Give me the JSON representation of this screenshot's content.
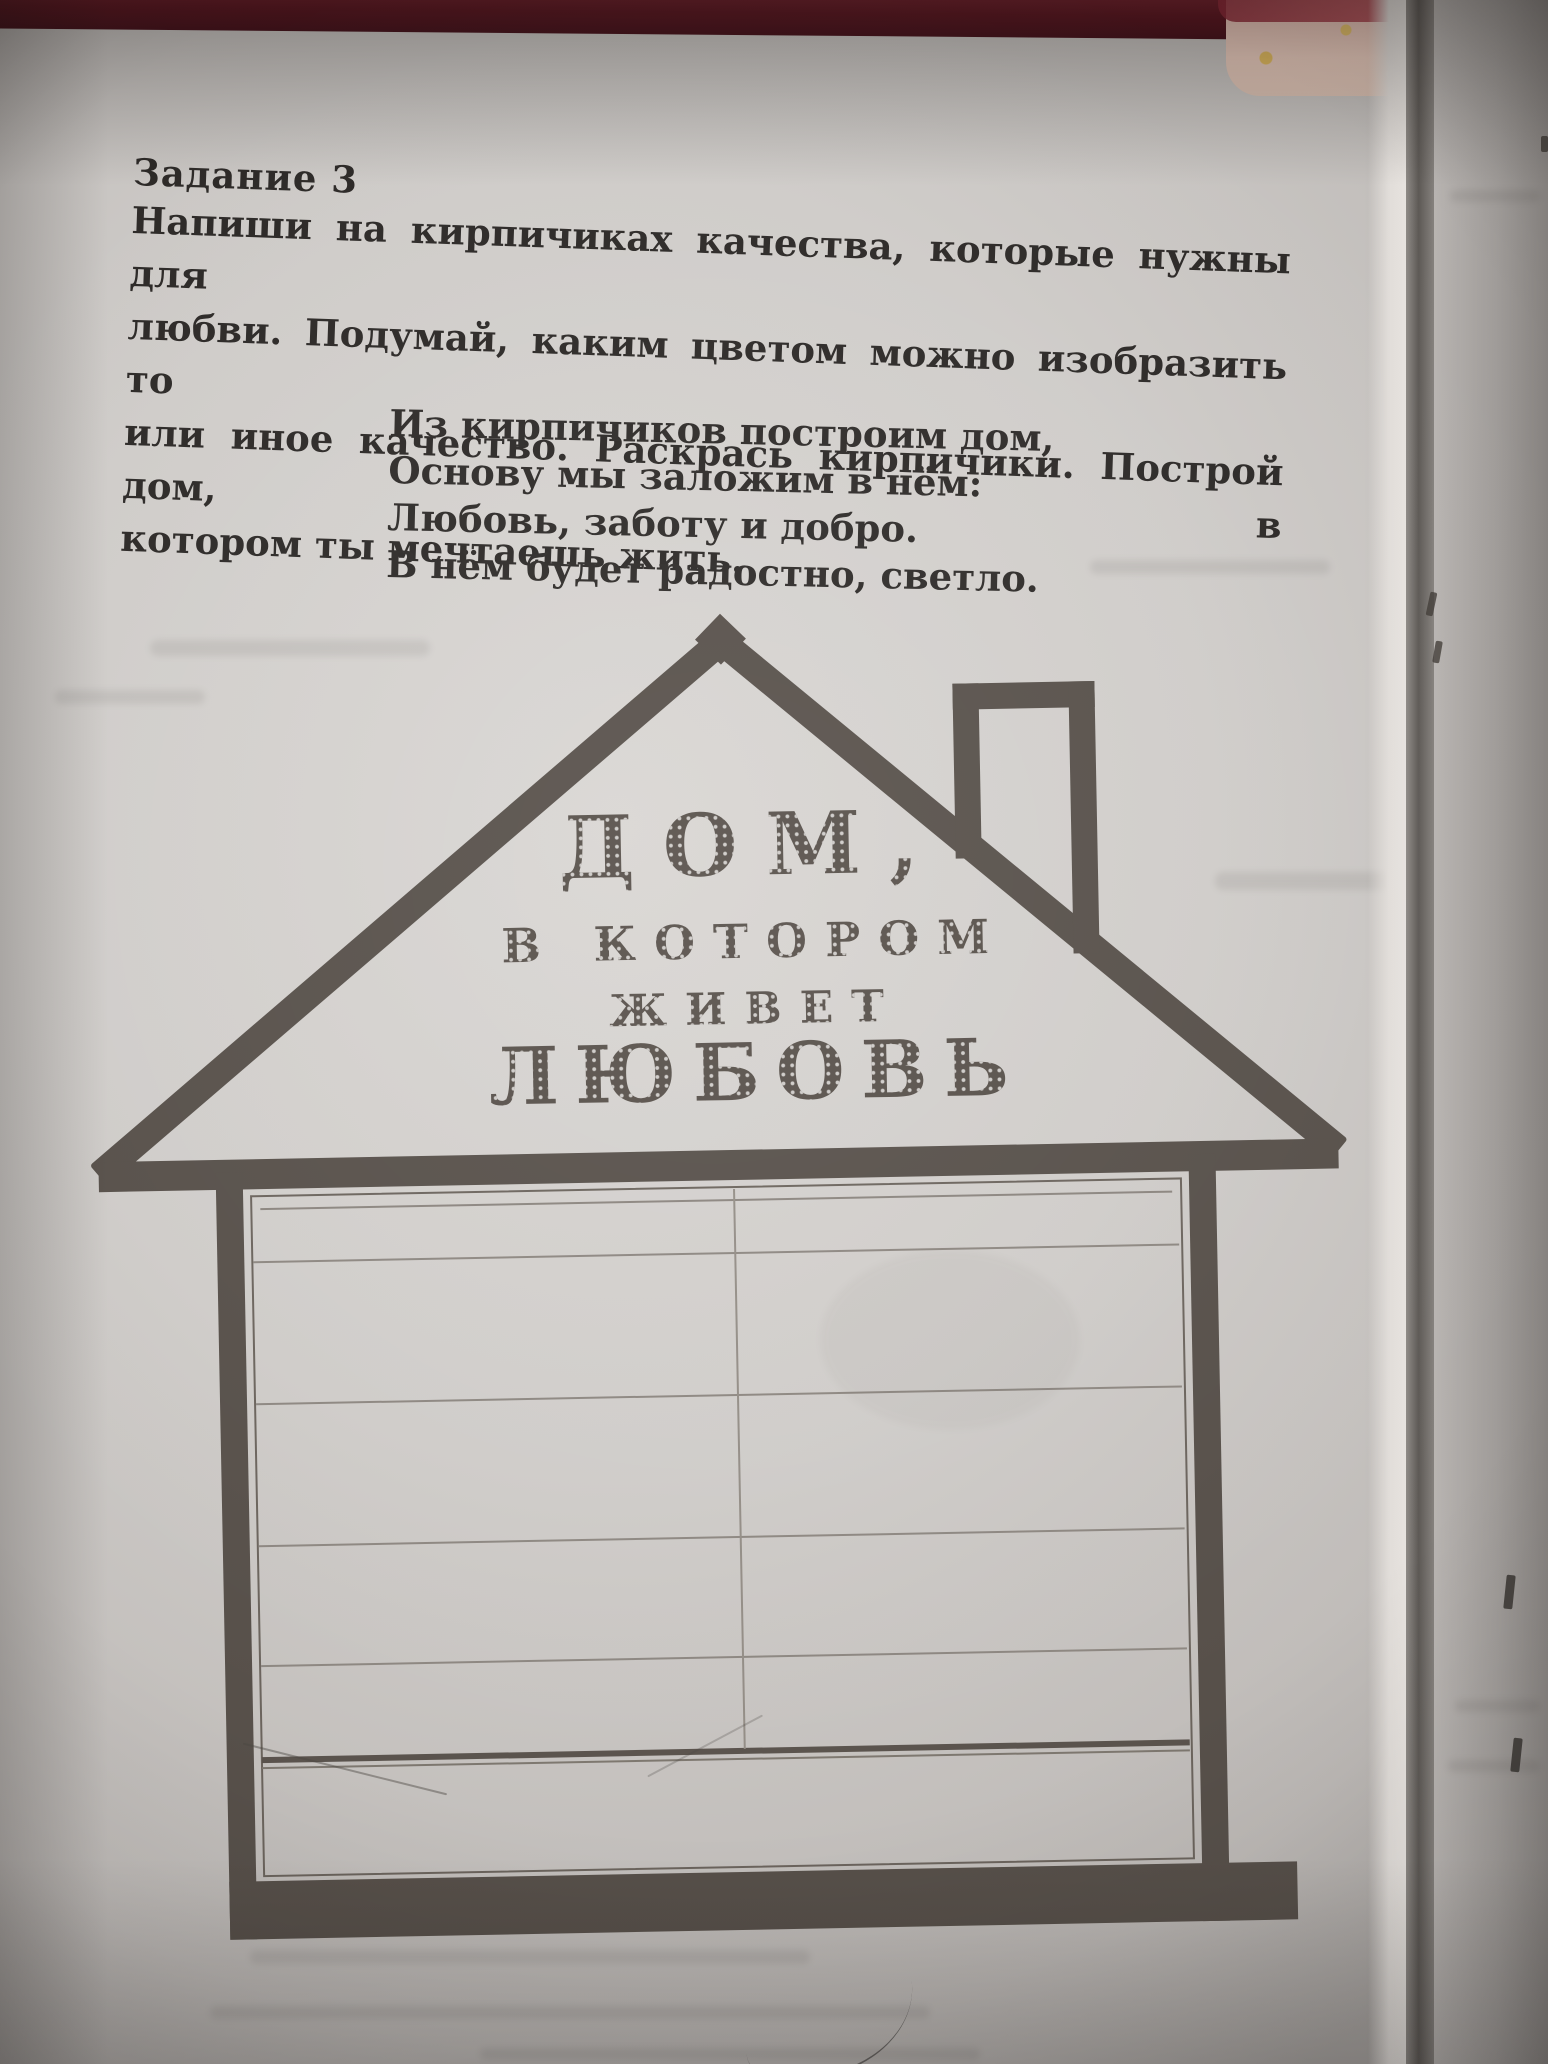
{
  "doc": {
    "task_label": "Задание 3",
    "instruction_lines": [
      "Напиши на кирпичиках качества, которые нужны для",
      "любви. Подумай, каким цветом можно изобразить то",
      "или иное качество. Раскрась кирпичики. Построй дом, в",
      "котором ты мечтаешь жить."
    ],
    "poem_lines": [
      "Из кирпичиков построим дом,",
      "Основу мы заложим в нём:",
      "Любовь, заботу и добро.",
      "В нём будет радостно, светло."
    ]
  },
  "house": {
    "roof_lines": [
      "ДОМ,",
      "В КОТОРОМ",
      "ЖИВЕТ",
      "ЛЮБОВЬ"
    ],
    "brick_rows": 6,
    "colors": {
      "ink": "#57504a",
      "grid_line": "#8d8781",
      "paper": "#d3d0cd"
    }
  },
  "photo": {
    "colors": {
      "cover_strip": "#5a141f",
      "fabric": "#e7cabc",
      "fabric_dot": "#dfb95e",
      "facing_page": "#b2aeab"
    }
  }
}
